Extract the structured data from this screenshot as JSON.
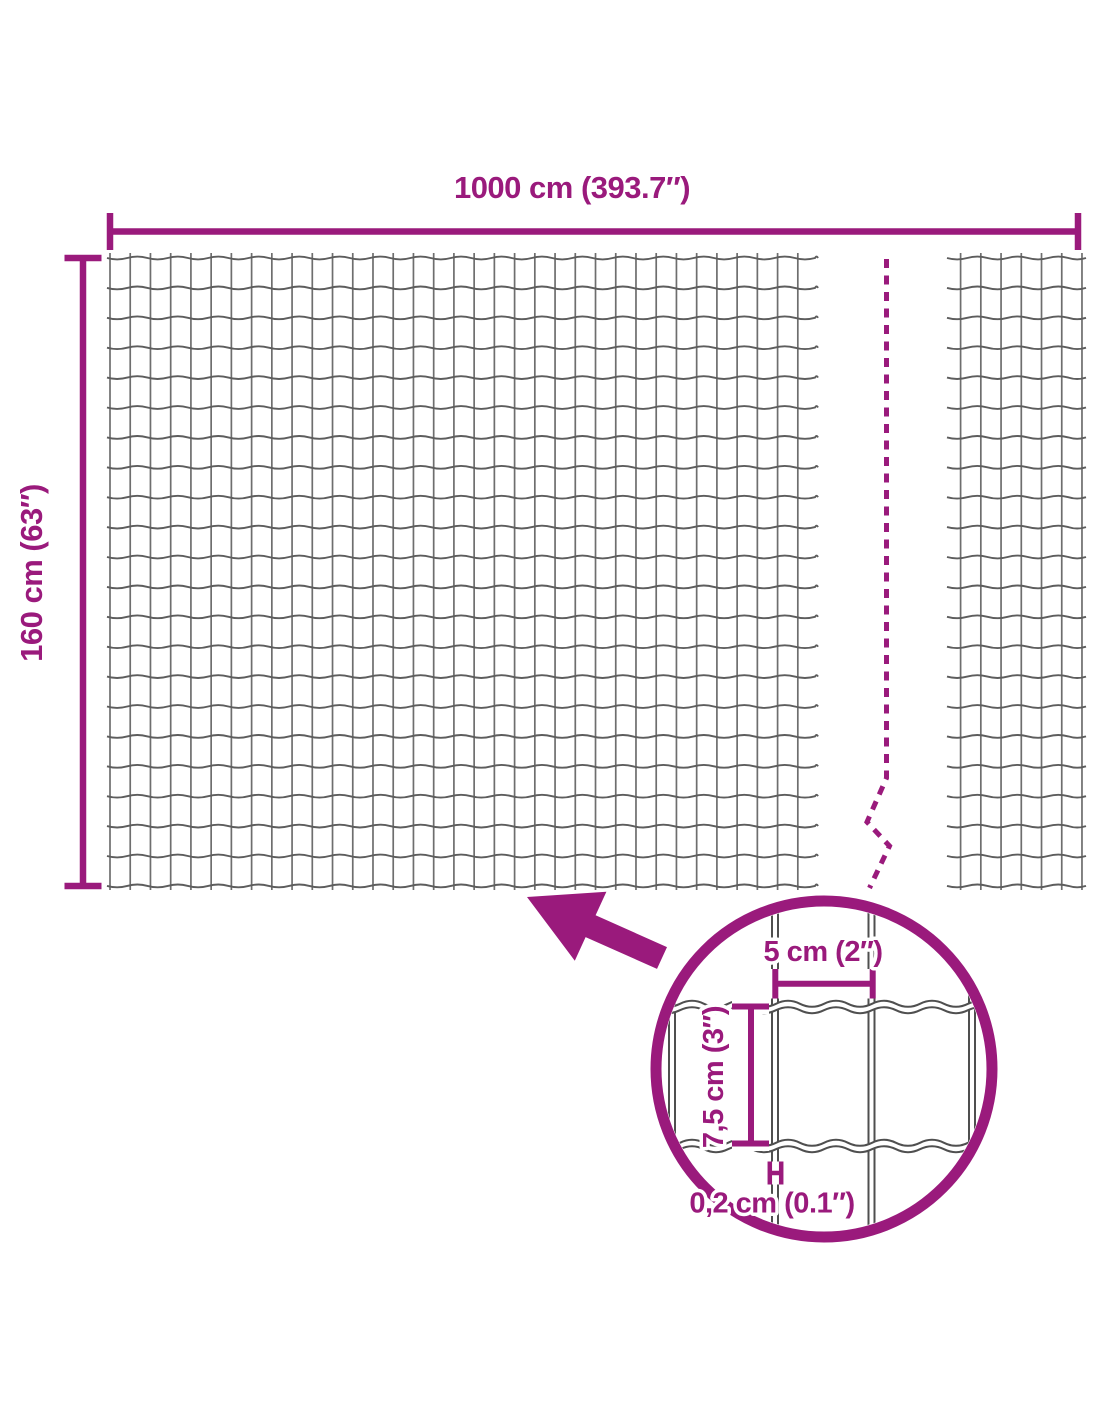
{
  "colors": {
    "accent": "#9A1A7C",
    "wire_gray": "#5d5d5d",
    "background": "#ffffff"
  },
  "labels": {
    "width": "1000 cm (393.7″)",
    "height": "160 cm (63″)"
  },
  "detail_labels": {
    "mesh_width": "5 cm (2″)",
    "mesh_height": "7,5 cm (3″)",
    "wire_thickness": "0,2 cm (0.1″)"
  }
}
